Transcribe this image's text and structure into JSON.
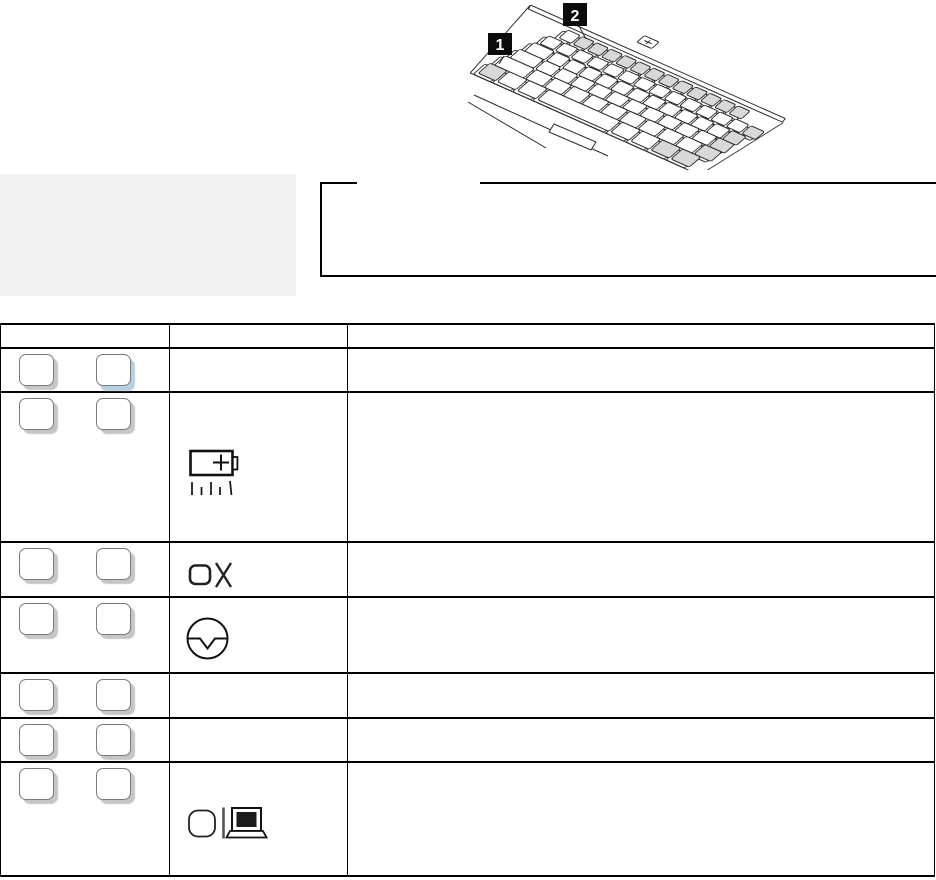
{
  "page": {
    "background": "#ffffff"
  },
  "figure": {
    "callouts": [
      {
        "label": "1",
        "points_to": "fn-key"
      },
      {
        "label": "2",
        "points_to": "function-key-row"
      }
    ],
    "highlighted_keys": [
      "fn-key",
      "function-key-row",
      "right-edge-keys"
    ],
    "colors": {
      "line": "#2a2a2a",
      "key_highlight": "#d8d8d8",
      "callout_bg": "#0c0c0c",
      "callout_fg": "#ffffff"
    }
  },
  "gray_note_box": {
    "text": "",
    "background": "#f2f2f2"
  },
  "outlined_note_box": {
    "title": "",
    "body": "",
    "border_color": "#000000"
  },
  "table": {
    "border_color": "#000000",
    "header": {
      "col1": "",
      "col2": "",
      "col3": ""
    },
    "key_style": {
      "fill": "#ffffff",
      "border": "#7a7a7a",
      "shadow": "#c6c6c6",
      "shadow_blue": "#b8cfdf"
    },
    "rows": [
      {
        "keys": [
          {
            "label": "",
            "shadow": "gray"
          },
          {
            "label": "",
            "shadow": "blue"
          }
        ],
        "icon": null,
        "description": ""
      },
      {
        "keys": [
          {
            "label": "",
            "shadow": "gray"
          },
          {
            "label": "",
            "shadow": "gray"
          }
        ],
        "icon": "battery-icon",
        "description": ""
      },
      {
        "keys": [
          {
            "label": "",
            "shadow": "gray"
          },
          {
            "label": "",
            "shadow": "gray"
          }
        ],
        "icon": "screen-blank-icon",
        "description": ""
      },
      {
        "keys": [
          {
            "label": "",
            "shadow": "gray"
          },
          {
            "label": "",
            "shadow": "gray"
          }
        ],
        "icon": "standby-icon",
        "description": ""
      },
      {
        "keys": [
          {
            "label": "",
            "shadow": "gray"
          },
          {
            "label": "",
            "shadow": "gray"
          }
        ],
        "icon": null,
        "description": ""
      },
      {
        "keys": [
          {
            "label": "",
            "shadow": "gray"
          },
          {
            "label": "",
            "shadow": "gray"
          }
        ],
        "icon": null,
        "description": ""
      },
      {
        "keys": [
          {
            "label": "",
            "shadow": "gray"
          },
          {
            "label": "",
            "shadow": "gray"
          }
        ],
        "icon": "display-switch-icon",
        "description": ""
      }
    ]
  }
}
